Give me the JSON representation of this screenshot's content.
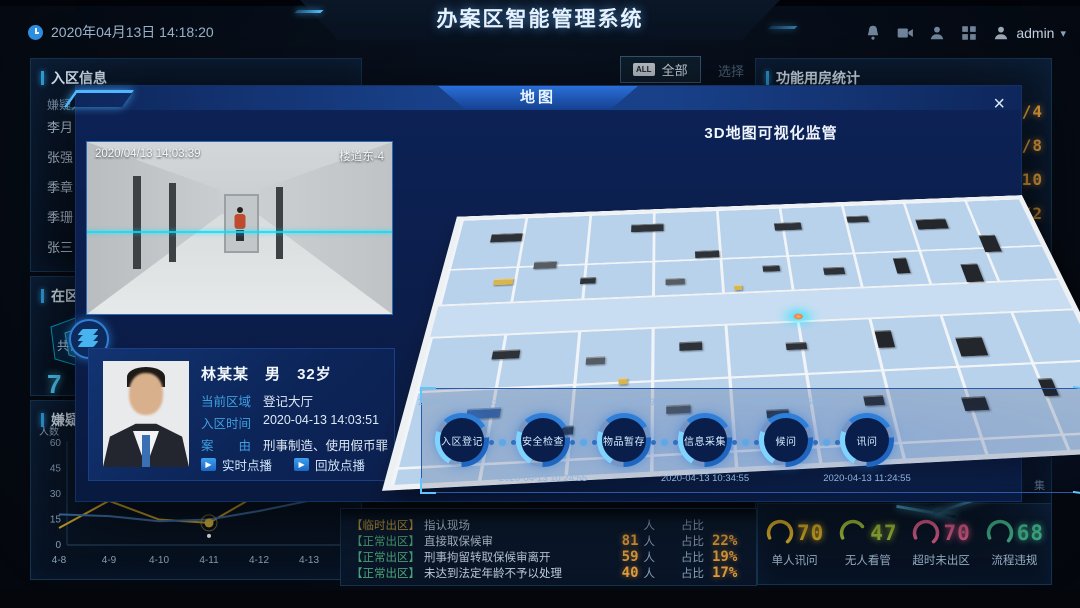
{
  "header": {
    "title": "办案区智能管理系统",
    "datetime": "2020年04月13日  14:18:20",
    "username": "admin",
    "caret": "▾"
  },
  "toolbar": {
    "all_badge": "ALL",
    "all_label": "全部",
    "select_label": "选择"
  },
  "left": {
    "entry_panel": {
      "title": "入区信息",
      "column": "嫌疑人",
      "names": [
        "李月",
        "张强",
        "季章",
        "季珊",
        "张三"
      ]
    },
    "inzone_panel": {
      "title": "在区人",
      "total_label": "共计",
      "total_partial": "7"
    },
    "trend_panel": {
      "title": "嫌疑人",
      "ylabel": "人数"
    }
  },
  "right_panel": {
    "title": "功能用房统计",
    "capacities": [
      "/4",
      "/8",
      "/10",
      "/2"
    ],
    "fragments": [
      "默认",
      "件",
      "集"
    ]
  },
  "exit_list": {
    "rows": [
      {
        "tag": "【临时出区】",
        "tag_color": "#c9a23c",
        "label": "指认现场",
        "value": "",
        "unit": "人",
        "ratio_label": "占比",
        "pct": ""
      },
      {
        "tag": "【正常出区】",
        "tag_color": "#4fae7c",
        "label": "直接取保候审",
        "value": "81",
        "unit": "人",
        "ratio_label": "占比",
        "pct": "22%"
      },
      {
        "tag": "【正常出区】",
        "tag_color": "#4fae7c",
        "label": "刑事拘留转取保候审离开",
        "value": "59",
        "unit": "人",
        "ratio_label": "占比",
        "pct": "19%"
      },
      {
        "tag": "【正常出区】",
        "tag_color": "#4fae7c",
        "label": "未达到法定年龄不予以处理",
        "value": "40",
        "unit": "人",
        "ratio_label": "占比",
        "pct": "17%"
      }
    ]
  },
  "gauges": [
    {
      "value": "70",
      "label": "单人讯问",
      "color": "#e0b52a"
    },
    {
      "value": "47",
      "label": "无人看管",
      "color": "#a8c63c"
    },
    {
      "value": "70",
      "label": "超时未出区",
      "color": "#e0608e"
    },
    {
      "value": "68",
      "label": "流程违规",
      "color": "#3fae87"
    }
  ],
  "modal": {
    "title": "地图",
    "close_label": "×",
    "video": {
      "timestamp": "2020/04/13 14:03:39",
      "camera": "楼道东-4"
    },
    "map_title": "3D地图可视化监管",
    "person": {
      "name": "林某某",
      "gender": "男",
      "age": "32岁",
      "fields": [
        {
          "label": "当前区域",
          "value": "登记大厅"
        },
        {
          "label": "入区时间",
          "value": "2020-04-13  14:03:51"
        },
        {
          "label": "案　　由",
          "value": "刑事制造、使用假币罪"
        }
      ],
      "buttons": [
        "实时点播",
        "回放点播"
      ]
    },
    "timeline": {
      "nodes": [
        {
          "label": "入区登记",
          "time": "2020-04-13 10:14:55",
          "time_pos": "top"
        },
        {
          "label": "安全检查",
          "time": "2020-04-13 10:24:55",
          "time_pos": "bottom"
        },
        {
          "label": "物品暂存",
          "time": "2020-04-13 10:29:55",
          "time_pos": "top"
        },
        {
          "label": "信息采集",
          "time": "2020-04-13 10:34:55",
          "time_pos": "bottom"
        },
        {
          "label": "候问",
          "time": "2020-04-13 10:54:55",
          "time_pos": "top"
        },
        {
          "label": "讯问",
          "time": "2020-04-13 11:24:55",
          "time_pos": "bottom"
        }
      ]
    }
  },
  "chart_data": {
    "type": "line",
    "x": [
      "4-8",
      "4-9",
      "4-10",
      "4-11",
      "4-12",
      "4-13"
    ],
    "series": [
      {
        "name": "yellow-line",
        "color": "#c9a227",
        "values": [
          10,
          26,
          15,
          13,
          30,
          27
        ]
      },
      {
        "name": "blue-line",
        "color": "#3f6fa8",
        "values": [
          18,
          17,
          14,
          15,
          20,
          26
        ]
      }
    ],
    "title": "嫌疑人",
    "xlabel": "",
    "ylabel": "人数",
    "ylim": [
      0,
      60
    ],
    "yticks": [
      60,
      45,
      30,
      15,
      0
    ],
    "marker_index": 3,
    "legend": "none",
    "grid": false
  }
}
